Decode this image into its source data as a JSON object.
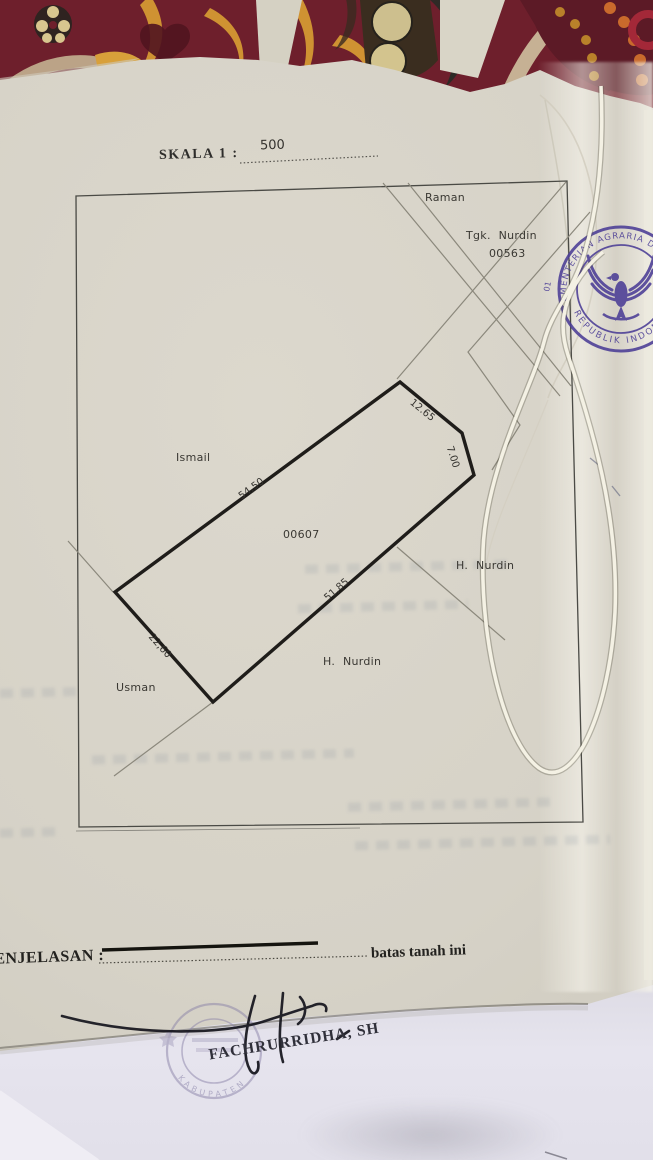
{
  "scale": {
    "label": "SKALA 1 :",
    "value": "500"
  },
  "map": {
    "parcel_number": "00607",
    "neighbors": {
      "raman": "Raman",
      "tgk_nurdin_name": "Tgk. Nurdin",
      "tgk_nurdin_number": "00563",
      "ismail": "Ismail",
      "h_nurdin_east": "H. Nurdin",
      "h_nurdin_south": "H. Nurdin",
      "usman": "Usman"
    },
    "measurements": {
      "nw": "54,50",
      "ne_upper": "12.65",
      "ne_lower": "7.00",
      "se": "51,85",
      "sw": "22,60"
    }
  },
  "legend": {
    "label": "PENJELASAN :",
    "note": "batas tanah ini"
  },
  "signature": {
    "name": "FACHRURRIDHA, SH"
  },
  "stamps": {
    "ministry": {
      "arc_top": "KEMENTERIAN AGRARIA DAN TATA RUANG",
      "arc_bottom": "REPUBLIK INDONESIA",
      "code": "01"
    },
    "notary": {
      "arc_bottom": "KABUPATEN"
    }
  },
  "colors": {
    "stamp_purple": "#4b3d96",
    "paper_cream": "#d6d2c7",
    "paper_white": "#e4e2ec",
    "carpet_maroon": "#6e1f2c",
    "carpet_gold": "#cf9232",
    "mat_red": "#a41a40"
  }
}
